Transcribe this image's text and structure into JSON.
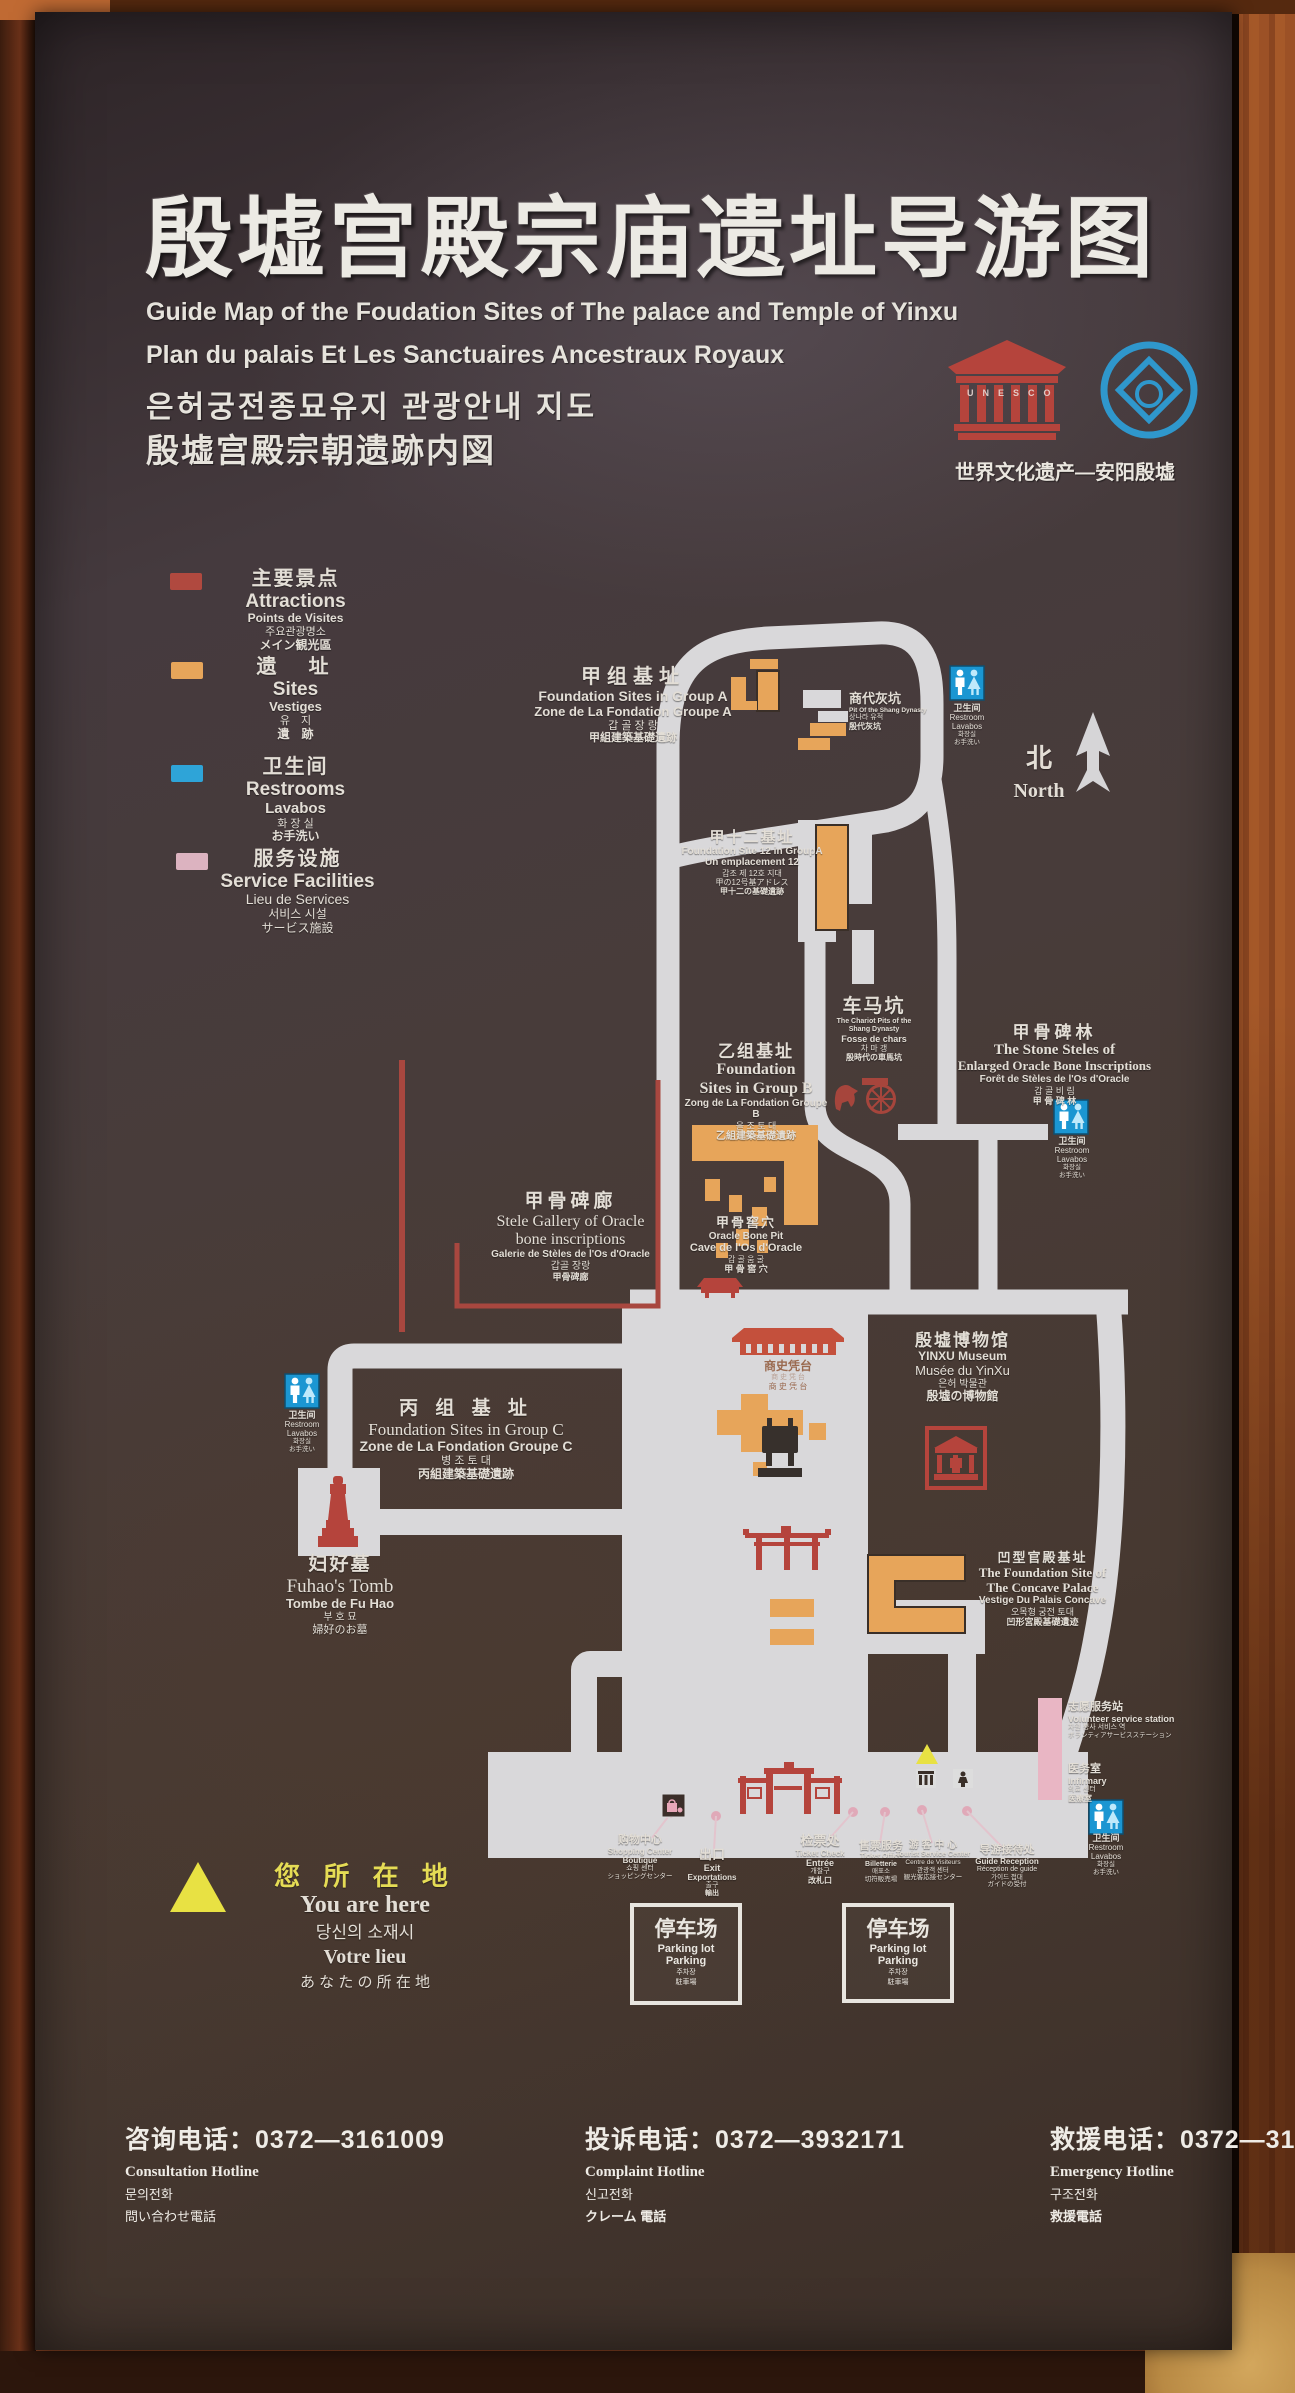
{
  "header": {
    "title_zh": "殷墟宫殿宗庙遗址导游图",
    "subtitle_en": "Guide Map of  the Foudation Sites of  The palace and Temple of Yinxu",
    "subtitle_fr": "Plan du palais Et Les Sanctuaires Ancestraux Royaux",
    "subtitle_ko": "은허궁전종묘유지 관광안내 지도",
    "subtitle_ja": "殷墟宫殿宗朝遗跡内図",
    "unesco_letters": "UNESCO",
    "heritage_caption": "世界文化遗产—安阳殷墟"
  },
  "legend": {
    "items": [
      {
        "id": "attractions",
        "color": "#b0493f",
        "zh": "主要景点",
        "en": "Attractions",
        "fr": "Points de Visites",
        "ko": "주요관광명소",
        "ja": "メイン観光區"
      },
      {
        "id": "sites",
        "color": "#e7a55a",
        "zh": "遗　址",
        "en": "Sites",
        "fr": "Vestiges",
        "ko": "유　지",
        "ja": "遺　跡"
      },
      {
        "id": "restrooms",
        "color": "#2ea4d8",
        "zh": "卫生间",
        "en": "Restrooms",
        "fr": "Lavabos",
        "ko": "화 장 실",
        "ja": "お手洗い"
      },
      {
        "id": "services",
        "color": "#dcb3c0",
        "zh": "服务设施",
        "en": "Service Facilities",
        "fr": "Lieu de Services",
        "ko": "서비스 시설",
        "ja": "サービス施設"
      }
    ]
  },
  "north": {
    "zh": "北",
    "en": "North"
  },
  "restroom_label": {
    "zh": "卫生间",
    "en": "Restroom",
    "fr": "Lavabos",
    "ko": "화장실",
    "ja": "お手洗い"
  },
  "map": {
    "group_a": {
      "zh": "甲组基址",
      "en": "Foundation Sites  in Group  A",
      "fr": "Zone  de La Fondation   Groupe   A",
      "ko": "갑 골 장 랑",
      "ja": "甲組建築基礎遺跡"
    },
    "site12": {
      "zh": "甲十二基址",
      "en": "Foundation Site 12 in GroupA",
      "fr": "Un emplacement 12",
      "ko": "갑조 제 12호 지대",
      "ja1": "甲の12号基アドレス",
      "ja2": "甲十二の基礎遺跡"
    },
    "shang_pit": {
      "zh": "商代灰坑",
      "en": "Pit Of the Shang Dynasty",
      "ko": "상나라 유적",
      "ja": "殷代灰坑"
    },
    "chariot": {
      "zh": "车马坑",
      "en1": "The Chariot Pits of the",
      "en2": "Shang Dynasty",
      "fr": "Fosse de chars",
      "ko": "차 마 갱",
      "ja": "殷時代の車馬坑"
    },
    "group_b": {
      "zh": "乙组基址",
      "en1": "Foundation",
      "en2": "Sites in Group B",
      "fr": "Zong de La Fondation Groupe B",
      "ko": "을 조 토 대",
      "ja": "乙組建築基礎遺跡"
    },
    "stele_forest": {
      "zh": "甲骨碑林",
      "en1": "The Stone Steles of",
      "en2": "Enlarged  Oracle Bone Inscriptions",
      "fr": "Forêt de Stèles de l'Os d'Oracle",
      "ko": "갑 골 비 림",
      "ja": "甲 骨 碑 林"
    },
    "stele_gallery": {
      "zh": "甲骨碑廊",
      "en1": "Stele Gallery of  Oracle",
      "en2": "bone inscriptions",
      "fr": "Galerie de Stèles de l'Os d'Oracle",
      "ko": "갑골 장랑",
      "ja": "甲骨碑廊"
    },
    "oracle_pit": {
      "zh": "甲骨窖穴",
      "en": "Oracle  Bone  Pit",
      "fr": "Cave de l'Os d'Oracle",
      "ko": "갑 골 움 굴",
      "ja": "甲 骨 窖 穴"
    },
    "group_c": {
      "zh": "丙 组 基 址",
      "en": "Foundation Sites in Group C",
      "fr": "Zone de La Fondation Groupe C",
      "ko": "병 조  토 대",
      "ja": "丙組建築基礎遺跡"
    },
    "fuhao": {
      "zh": "妇好墓",
      "en": "Fuhao's  Tomb",
      "fr": "Tombe de Fu Hao",
      "ko": "부  호  묘",
      "ja": "婦好のお墓"
    },
    "museum": {
      "zh": "殷墟博物馆",
      "en": "YINXU  Museum",
      "fr": "Musée du YinXu",
      "ko": "은허 박물관",
      "ja": "殷墟の博物館"
    },
    "hall": {
      "zh": "商史凭台",
      "sub": "商 史 凭 台"
    },
    "concave": {
      "zh": "凹型官殿基址",
      "en1": "The Foundation Site of",
      "en2": "The Concave Palace",
      "fr": "Vestige Du Palais Concave",
      "ko": "오목형 궁전 토대",
      "ja": "凹形宮殿基礎遺迹"
    },
    "volunteer": {
      "zh": "志愿服务站",
      "en": "Volunteer service station",
      "ko": "자원 봉사 서비스 역",
      "ja": "ボランティアサービスステーション"
    },
    "infirmary": {
      "zh": "医务室",
      "en": "Infirmary",
      "ko": "의료 센터",
      "ja": "医療室"
    },
    "shopping": {
      "zh": "购物中心",
      "en": "Shopping Center",
      "fr": "Boutique",
      "ko": "쇼핑 센터",
      "ja": "ショッピングセンター"
    },
    "exit": {
      "zh": "出口",
      "en": "Exit",
      "fr": "Exportations",
      "ko": "출구",
      "ja": "輸出"
    },
    "ticket_check": {
      "zh": "检票处",
      "en": "Ticket Check",
      "fr": "Entrée",
      "ko": "개찰구",
      "ja": "改札口"
    },
    "ticket_office": {
      "zh": "售票服务",
      "en": "Ticket Office",
      "fr": "Billetterie",
      "ko": "매표소",
      "ja": "切符販売場"
    },
    "tourist_center": {
      "zh": "游 客 中 心",
      "en": "Tourist Service Center",
      "fr": "Centre de Visiteurs",
      "ko": "관광객 센터",
      "ja": "観光客応接センター"
    },
    "guide_reception": {
      "zh": "导游接待处",
      "en": "Guide  Reception",
      "fr": "Réception de guide",
      "ko": "가이드 접대",
      "ja": "ガイドの受付"
    },
    "parking": {
      "zh": "停车场",
      "en": "Parking lot",
      "fr": "Parking",
      "ko": "주차장",
      "ja": "駐車場"
    }
  },
  "you_are_here": {
    "zh": "您 所 在 地",
    "en": "You are here",
    "ko": "당신의  소재시",
    "fr": "Votre lieu",
    "ja": "あ な た の 所 在 地"
  },
  "hotlines": [
    {
      "zh": "咨询电话：",
      "number": "0372—3161009",
      "en": "Consultation Hotline",
      "ko": "문의전화",
      "ja": "問い合わせ電話"
    },
    {
      "zh": "投诉电话：",
      "number": "0372—3932171",
      "en": "Complaint Hotline",
      "ko": "신고전화",
      "ja": "クレーム 電話"
    },
    {
      "zh": "救援电话：",
      "number": "0372—3161007",
      "en": "Emergency Hotline",
      "ko": "구조전화",
      "ja": "救援電話"
    }
  ]
}
